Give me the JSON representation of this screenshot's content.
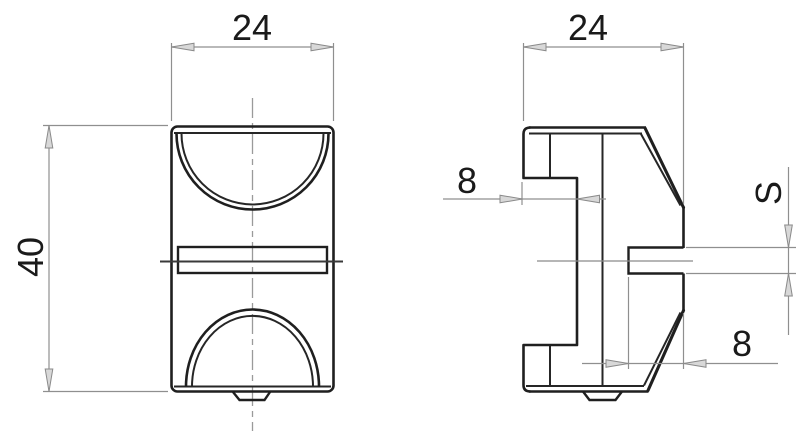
{
  "drawing": {
    "type": "two-view technical drawing of clamp block",
    "colors": {
      "background": "#ffffff",
      "outline": "#1f1f1f",
      "dimension_lines": "#8f8f8f",
      "arrow_fill": "#d8d8d8",
      "text": "#1a1a1a",
      "centerline": "#9a9a9a"
    },
    "front_view": {
      "width_label": "24",
      "height_label": "40"
    },
    "side_view": {
      "width_label": "24",
      "top_step_label": "8",
      "slot_depth_label": "8",
      "slot_thickness_label": "S"
    }
  }
}
